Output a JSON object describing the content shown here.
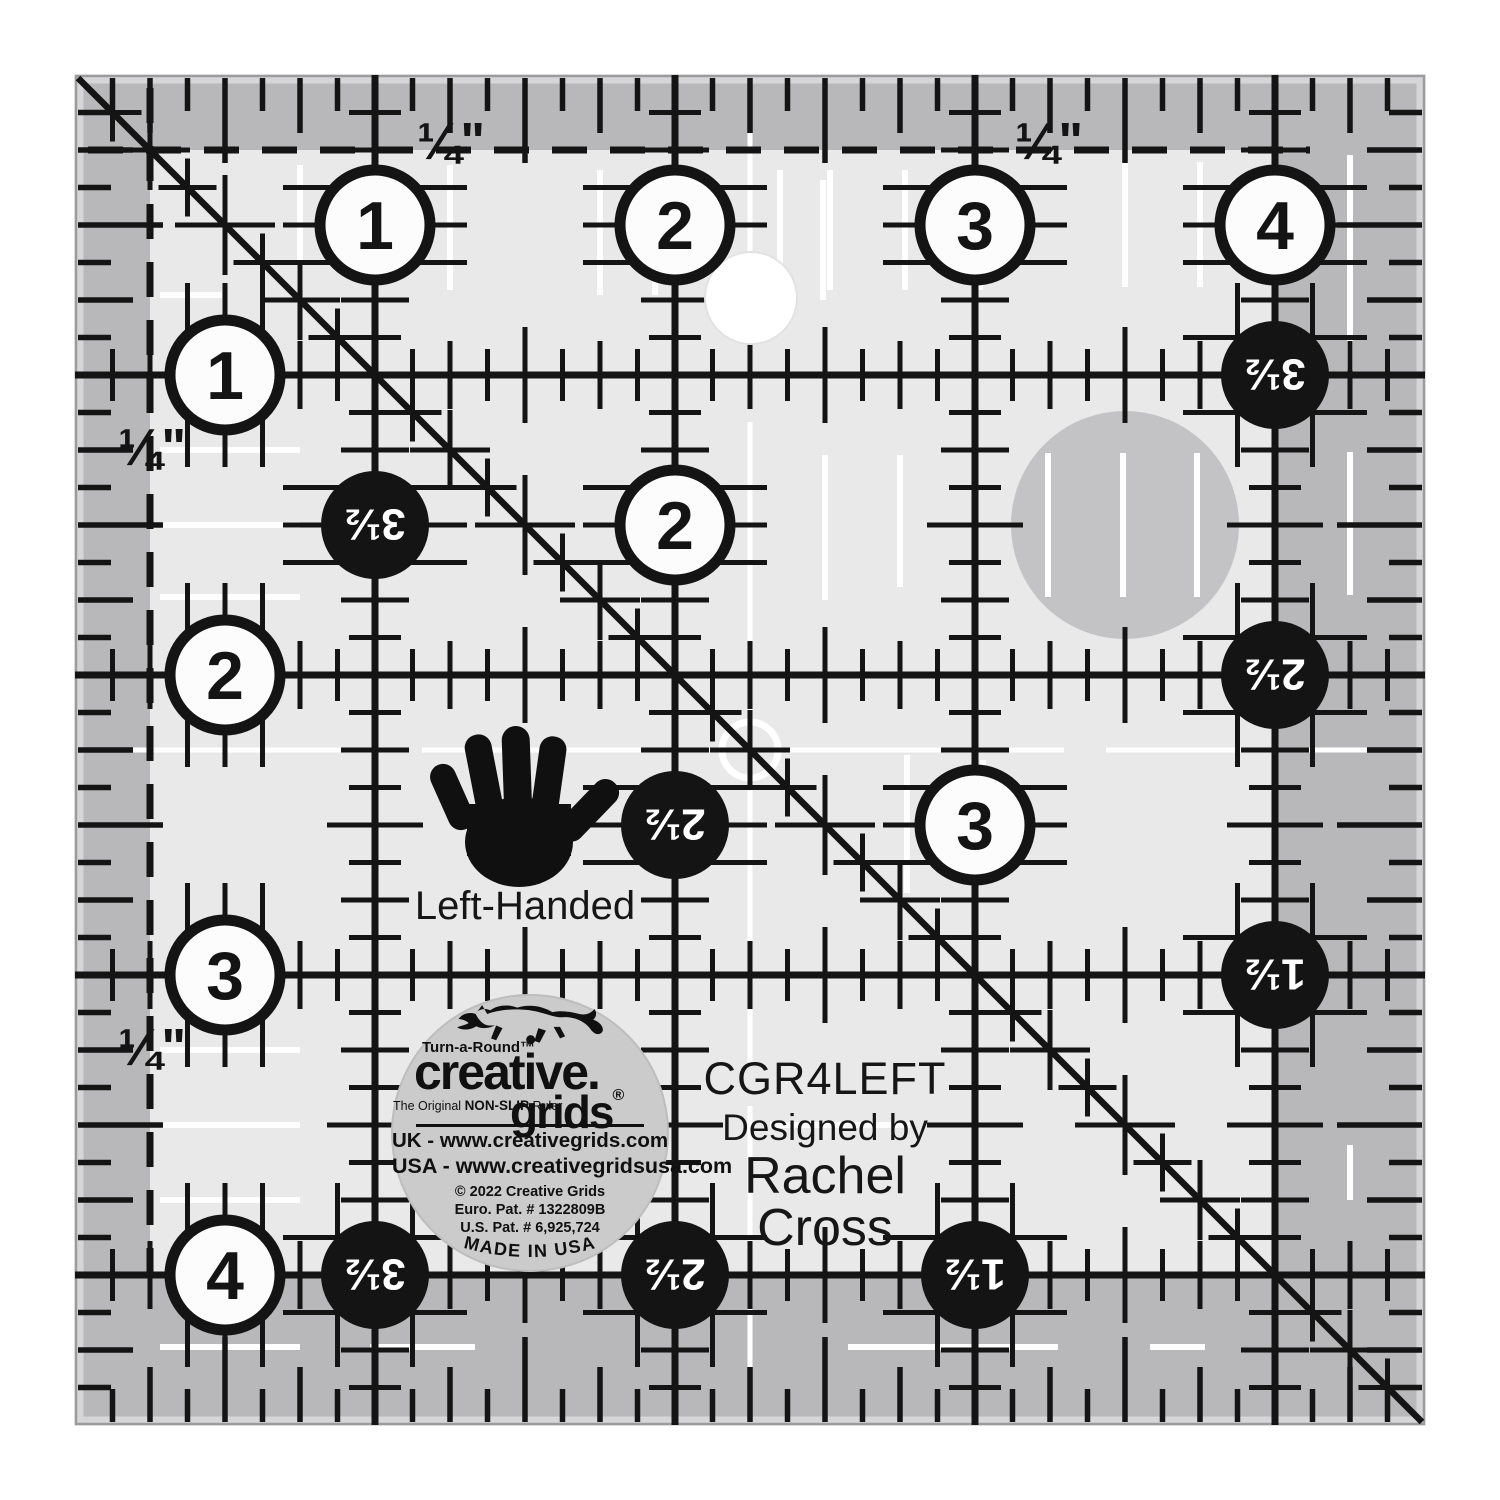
{
  "product": {
    "sku": "CGR4LEFT",
    "designed_by": "Designed by",
    "designer": "Rachel Cross",
    "hand_label": "Left-Handed"
  },
  "logo": {
    "turnaround": "Turn-a-Round™",
    "brand_top": "creative.",
    "brand_bottom": "grids",
    "registered": "®",
    "tagline_pre": "The Original ",
    "tagline_bold": "NON-SLIP",
    "tagline_post": " Ruler",
    "uk_line": "UK - www.creativegrids.com",
    "usa_line": "USA - www.creativegridsusa.com",
    "copyright_line": "© 2022  Creative Grids",
    "euro_pat": "Euro. Pat. # 1322809B",
    "us_pat": "U.S. Pat. # 6,925,724",
    "made_in": "MADE IN USA"
  },
  "ruler": {
    "quarter_label": "¼\"",
    "white_circles": [
      {
        "label": "1",
        "x": 375,
        "y": 225
      },
      {
        "label": "2",
        "x": 675,
        "y": 225
      },
      {
        "label": "3",
        "x": 975,
        "y": 225
      },
      {
        "label": "4",
        "x": 1275,
        "y": 225
      },
      {
        "label": "1",
        "x": 225,
        "y": 375
      },
      {
        "label": "2",
        "x": 225,
        "y": 675
      },
      {
        "label": "3",
        "x": 225,
        "y": 975
      },
      {
        "label": "4",
        "x": 225,
        "y": 1275
      },
      {
        "label": "2",
        "x": 675,
        "y": 525
      },
      {
        "label": "3",
        "x": 975,
        "y": 825
      }
    ],
    "black_circles": [
      {
        "label": "3½",
        "x": 1275,
        "y": 375
      },
      {
        "label": "2½",
        "x": 1275,
        "y": 675
      },
      {
        "label": "1½",
        "x": 1275,
        "y": 975
      },
      {
        "label": "3½",
        "x": 375,
        "y": 525
      },
      {
        "label": "2½",
        "x": 675,
        "y": 825
      },
      {
        "label": "3½",
        "x": 375,
        "y": 1275
      },
      {
        "label": "2½",
        "x": 675,
        "y": 1275
      },
      {
        "label": "1½",
        "x": 975,
        "y": 1275
      }
    ],
    "quarter_label_positions": [
      {
        "x": 451,
        "y": 141
      },
      {
        "x": 1049,
        "y": 141
      },
      {
        "x": 152,
        "y": 447
      },
      {
        "x": 152,
        "y": 1047
      }
    ],
    "colors": {
      "ink": "#141414",
      "body": "#e9e9ea",
      "margin": "#b8b8ba",
      "bevel": "#d6d6d8",
      "outline": "#9c9c9e",
      "disc": "#c3c3c5",
      "logo_bg": "#cbcbcc",
      "white": "#ffffff"
    }
  }
}
